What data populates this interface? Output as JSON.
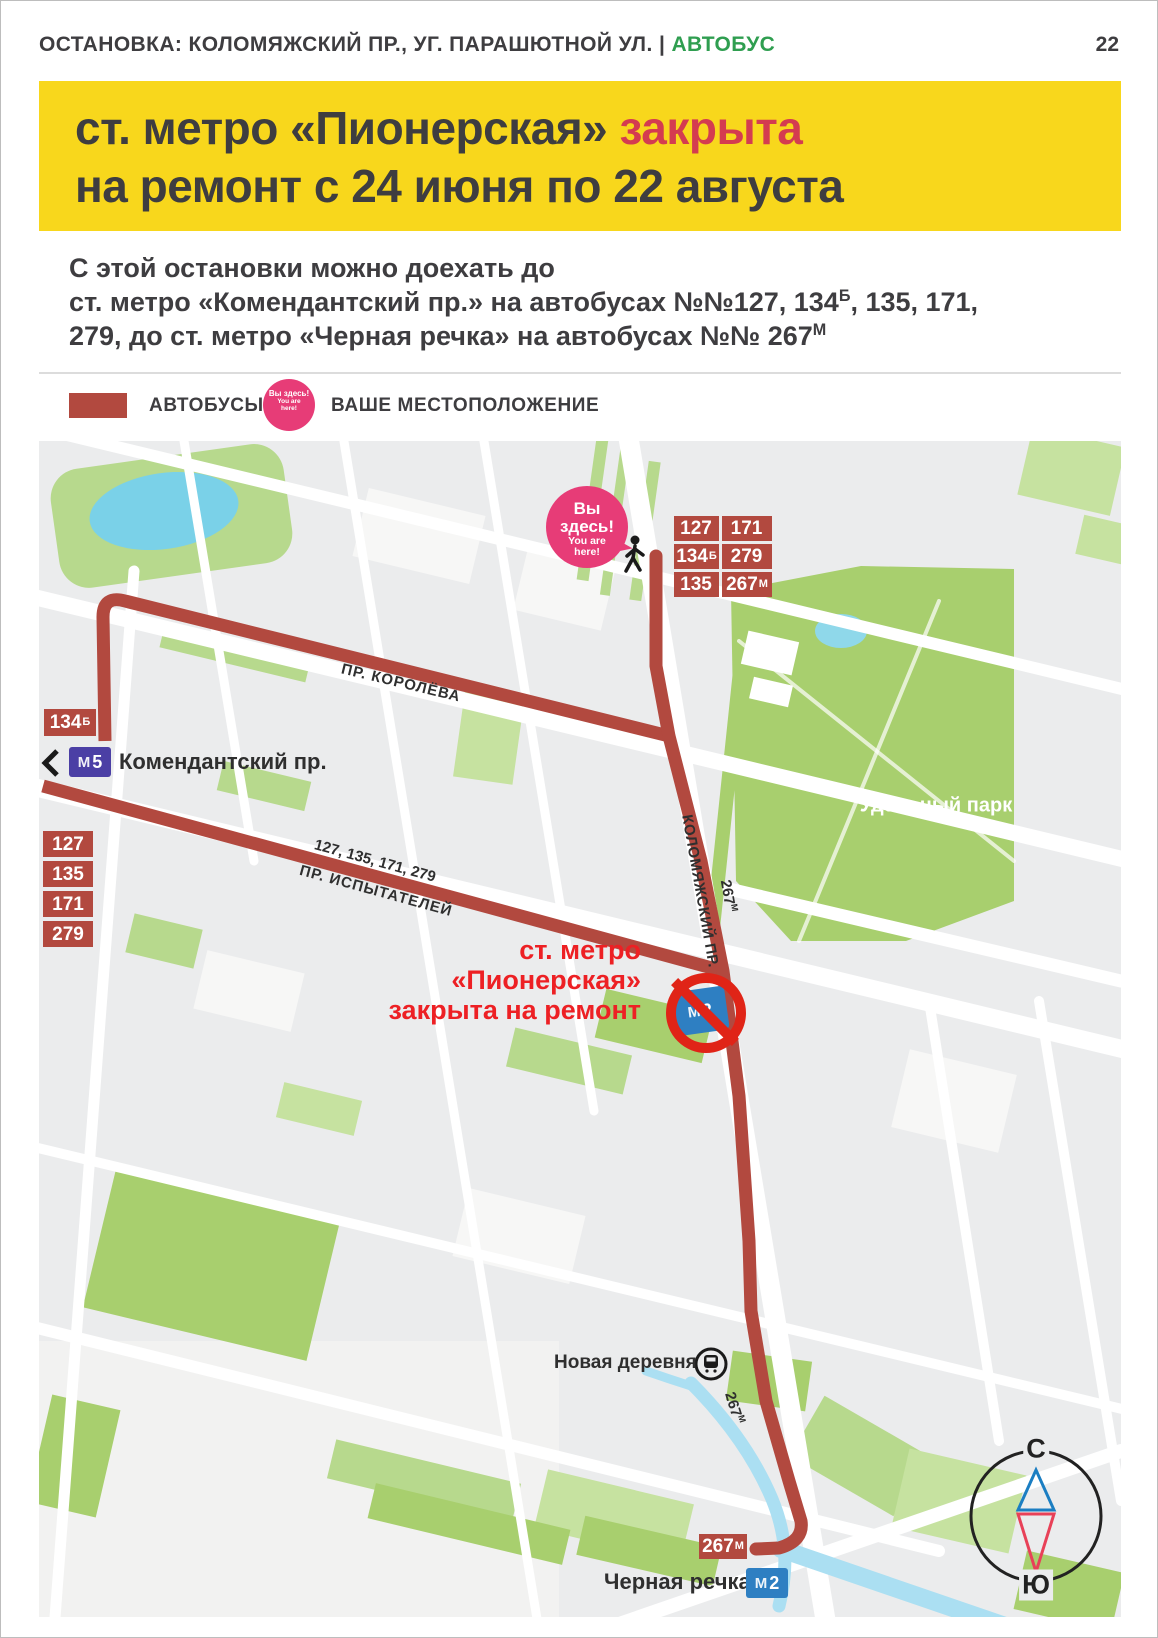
{
  "header": {
    "stop_label": "ОСТАНОВКА:",
    "stop_name": "КОЛОМЯЖСКИЙ ПР., УГ. ПАРАШЮТНОЙ УЛ.",
    "divider": "|",
    "mode": "АВТОБУС",
    "page_number": "22"
  },
  "banner": {
    "title_dark": "ст. метро «Пионерская»",
    "title_red": "закрыта",
    "line2": "на ремонт с 24 июня по 22 августа"
  },
  "intro": {
    "line1": "С этой остановки  можно доехать до",
    "line2_pre": "ст. метро «Комендантский пр.» на автобусах №№127, 134",
    "line2_sup": "Б",
    "line2_post": ", 135, 171,",
    "line3_pre": "279,  до ст. метро «Черная речка» на автобусах №№ 267",
    "line3_sup": "М"
  },
  "legend": {
    "buses_label": "АВТОБУСЫ",
    "location_label": "ВАШЕ МЕСТОПОЛОЖЕНИЕ"
  },
  "you_are_here": {
    "ru1": "Вы",
    "ru2": "здесь!",
    "en1": "You are",
    "en2": "here!"
  },
  "metro_logo": "М",
  "map": {
    "stop_badges": [
      {
        "n": "127"
      },
      {
        "n": "171"
      },
      {
        "n": "134",
        "s": "Б"
      },
      {
        "n": "279"
      },
      {
        "n": "135"
      },
      {
        "n": "267",
        "s": "М"
      }
    ],
    "badge_134": {
      "n": "134",
      "s": "Б"
    },
    "komendantsky": {
      "line": "5",
      "label": "Комендантский пр."
    },
    "left_badges": [
      {
        "n": "127"
      },
      {
        "n": "135"
      },
      {
        "n": "171"
      },
      {
        "n": "279"
      }
    ],
    "street_koroleva": "ПР. КОРОЛЁВА",
    "routes_on_ispytateley": "127, 135, 171, 279",
    "street_ispytateley": "ПР. ИСПЫТАТЕЛЕЙ",
    "street_kolomyazhsky": "КОЛОМЯЖСКИЙ ПР.",
    "label_267m_upper": {
      "n": "267",
      "s": "М"
    },
    "closed_note": {
      "line1": "ст. метро",
      "line2": "«Пионерская»",
      "line3": "закрыта на ремонт",
      "metro_line": "2"
    },
    "udelny_park": "Удельный парк",
    "novaya_derevnya": "Новая деревня",
    "label_267m_lower": {
      "n": "267",
      "s": "М"
    },
    "badge_267m": {
      "n": "267",
      "s": "М"
    },
    "chernaya_rechka": {
      "label": "Черная речка",
      "metro_line": "2"
    },
    "compass": {
      "north": "С",
      "south": "Ю"
    }
  },
  "colors": {
    "banner_bg": "#f8d71c",
    "banner_red": "#d43c50",
    "mode_green": "#2f9e50",
    "route_red": "#b2493f",
    "closed_red": "#ed2024",
    "prohibit_red": "#e02417",
    "pink_marker": "#e73c77",
    "metro_purple": "#4b3fa5",
    "metro_blue": "#2e7fc2",
    "park_green": "#a8cf6e",
    "water_blue": "#7ad1e8"
  }
}
